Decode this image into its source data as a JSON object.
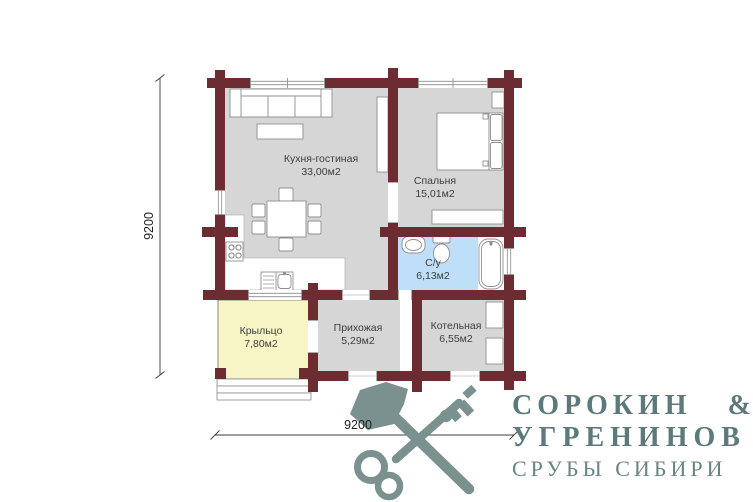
{
  "plan": {
    "rooms": [
      {
        "id": "kitchen-living",
        "name": "Кухня-гостиная",
        "area": "33,00м2"
      },
      {
        "id": "bedroom",
        "name": "Спальня",
        "area": "15,01м2"
      },
      {
        "id": "bathroom",
        "name": "С/у",
        "area": "6,13м2"
      },
      {
        "id": "porch",
        "name": "Крыльцо",
        "area": "7,80м2"
      },
      {
        "id": "hallway",
        "name": "Прихожая",
        "area": "5,29м2"
      },
      {
        "id": "boiler",
        "name": "Котельная",
        "area": "6,55м2"
      }
    ],
    "dimensions": {
      "vertical": "9200",
      "horizontal": "9200"
    }
  },
  "logo": {
    "line1": "СОРОКИН &",
    "line2": "УГРЕНИНОВ",
    "line3": "СРУБЫ СИБИРИ"
  },
  "colors": {
    "wall": "#6d2b32",
    "room_gray": "#d6d6d7",
    "bathroom_blue": "#bedff7",
    "porch_yellow": "#f7f4c5",
    "logo_teal": "#7b9190",
    "logo_text": "#5e797b"
  }
}
